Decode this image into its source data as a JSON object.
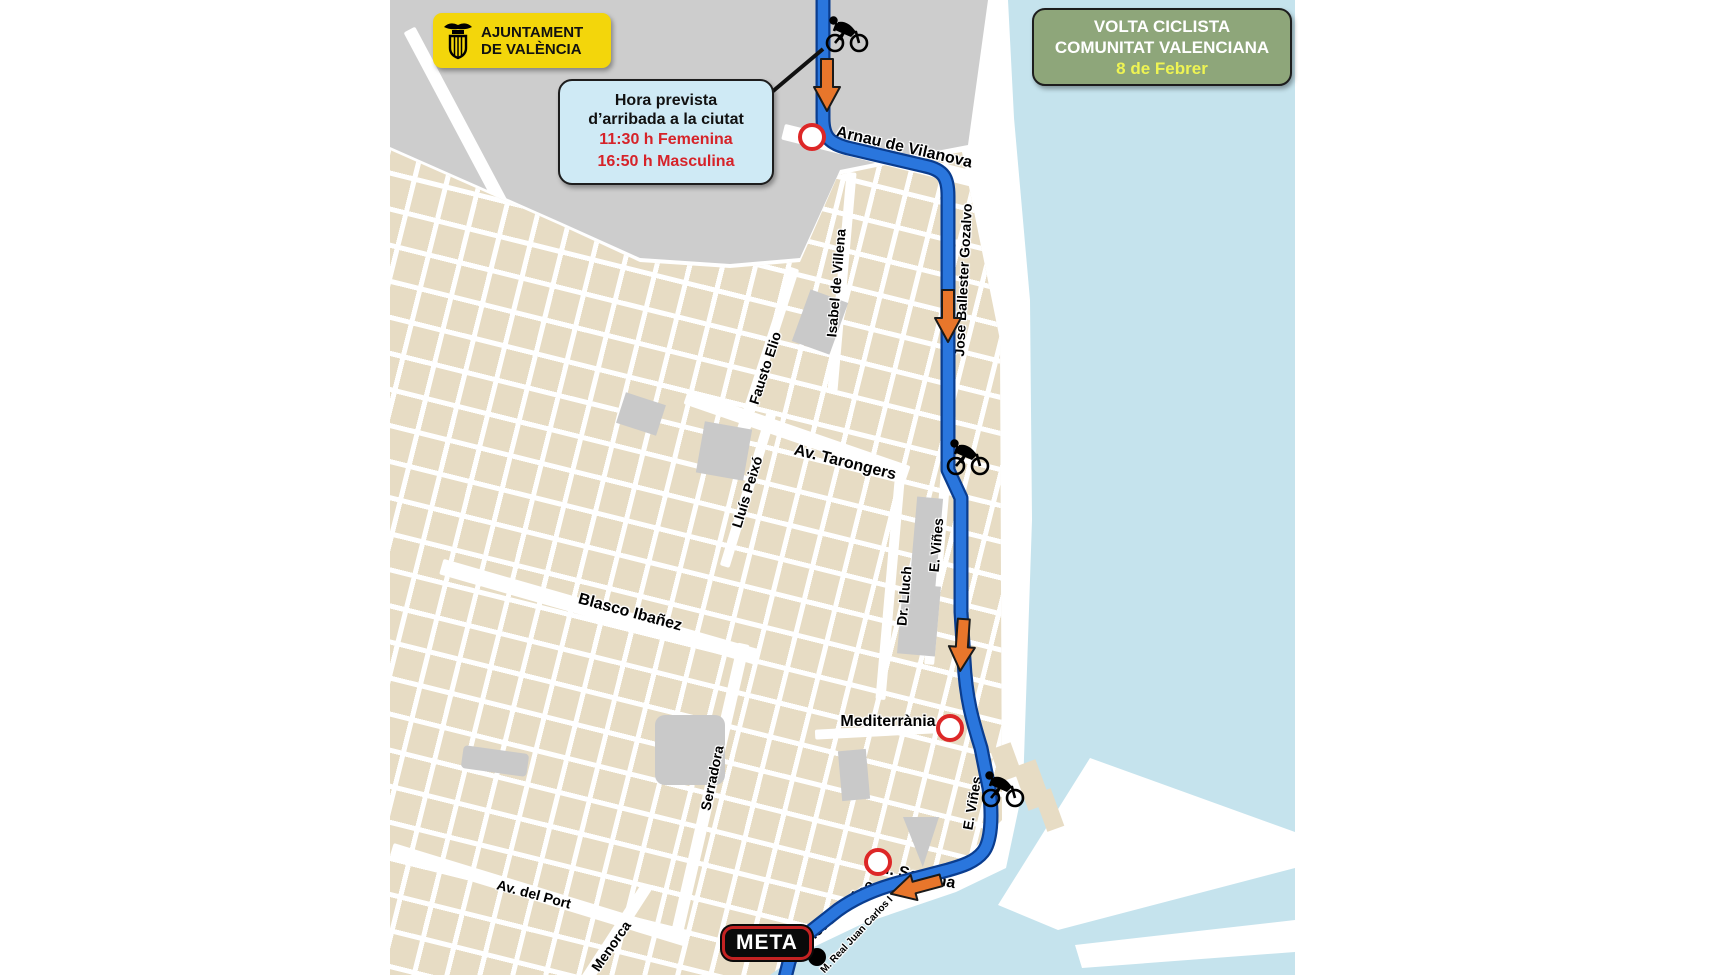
{
  "branding": {
    "ajuntament": {
      "line1": "AJUNTAMENT",
      "line2": "DE VALÈNCIA"
    }
  },
  "event_badge": {
    "title_line1": "VOLTA CICLISTA",
    "title_line2": "COMUNITAT VALENCIANA",
    "date": "8 de Febrer"
  },
  "arrival_box": {
    "heading_line1": "Hora prevista",
    "heading_line2": "d’arribada a la ciutat",
    "female_time": "11:30 h Femenina",
    "male_time": "16:50 h Masculina"
  },
  "finish": {
    "label": "META"
  },
  "streets": {
    "arnau_de_vilanova": "Arnau de Vilanova",
    "isabel_de_villena": "Isabel de Villena",
    "jose_ballester_gozalvo": "Jose Ballester Gozalvo",
    "fausto_elio": "Fausto Elio",
    "av_tarongers": "Av. Tarongers",
    "lluis_peixo": "Lluís Peixó",
    "e_vines_north": "E. Viñes",
    "dr_lluch": "Dr. Lluch",
    "blasco_ibanez": "Blasco Ibañez",
    "mediterrania": "Mediterrània",
    "serradora": "Serradora",
    "e_vines_south": "E. Viñes",
    "m_sopena": "M. Sopena",
    "jj_domine": "J.J. Dómine",
    "av_del_port": "Av. del Port",
    "menorca": "Menorca",
    "m_real_juan_carlos": "M. Real Juan Carlos I"
  },
  "colors": {
    "route_blue": "#2a76dd",
    "route_outline": "#0a3d8f",
    "arrow_orange": "#e8762b",
    "water": "#c5e3ed",
    "city_block": "#e7dcc4",
    "gray_zone": "#cdcdcd",
    "badge_yellow": "#f3d60b",
    "badge_green": "#8ea67a",
    "info_box_blue": "#cfeaf5",
    "time_red": "#d62329",
    "date_yellow": "#eef453",
    "marker_red": "#dd2727"
  }
}
